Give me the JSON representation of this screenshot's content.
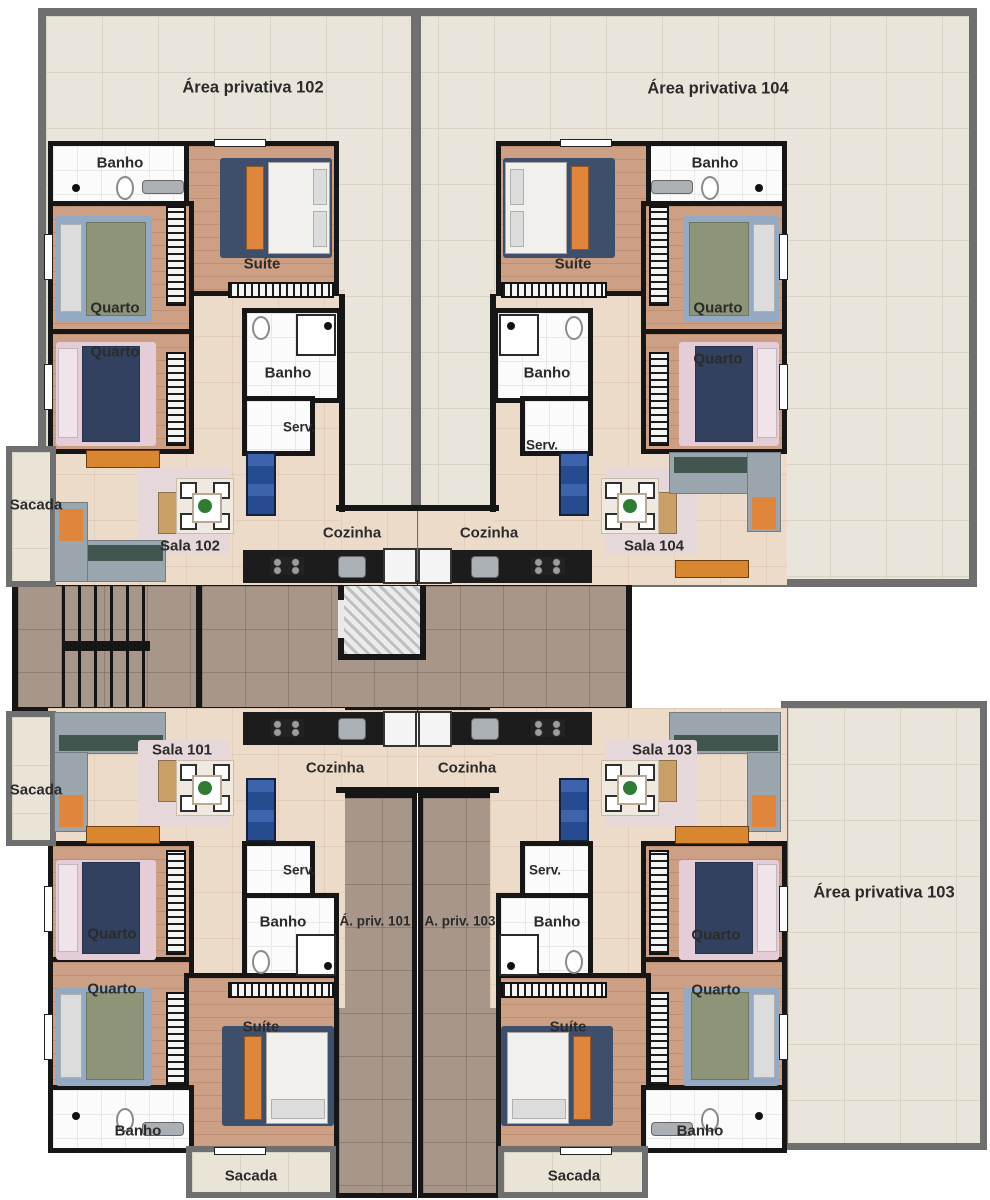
{
  "terraces": {
    "t102": "Área privativa 102",
    "t104": "Área privativa 104",
    "t103": "Área privativa 103"
  },
  "strips": {
    "s101": "Á. priv. 101",
    "s103": "A. priv. 103"
  },
  "units": {
    "u102": {
      "banho": "Banho",
      "suite": "Suíte",
      "quarto_a": "Quarto",
      "quarto_b": "Quarto",
      "banho_suite": "Banho",
      "serv": "Serv.",
      "sala": "Sala 102",
      "cozinha": "Cozinha",
      "sacada": "Sacada"
    },
    "u104": {
      "banho": "Banho",
      "suite": "Suíte",
      "quarto_a": "Quarto",
      "quarto_b": "Quarto",
      "banho_suite": "Banho",
      "serv": "Serv.",
      "sala": "Sala 104",
      "cozinha": "Cozinha"
    },
    "u101": {
      "banho": "Banho",
      "suite": "Suíte",
      "quarto_a": "Quarto",
      "quarto_b": "Quarto",
      "banho_suite": "Banho",
      "serv": "Serv.",
      "sala": "Sala 101",
      "cozinha": "Cozinha",
      "sacada": "Sacada",
      "sacada_bottom": "Sacada"
    },
    "u103": {
      "banho": "Banho",
      "suite": "Suíte",
      "quarto_a": "Quarto",
      "quarto_b": "Quarto",
      "banho_suite": "Banho",
      "serv": "Serv.",
      "sala": "Sala 103",
      "cozinha": "Cozinha",
      "sacada_bottom": "Sacada"
    }
  }
}
